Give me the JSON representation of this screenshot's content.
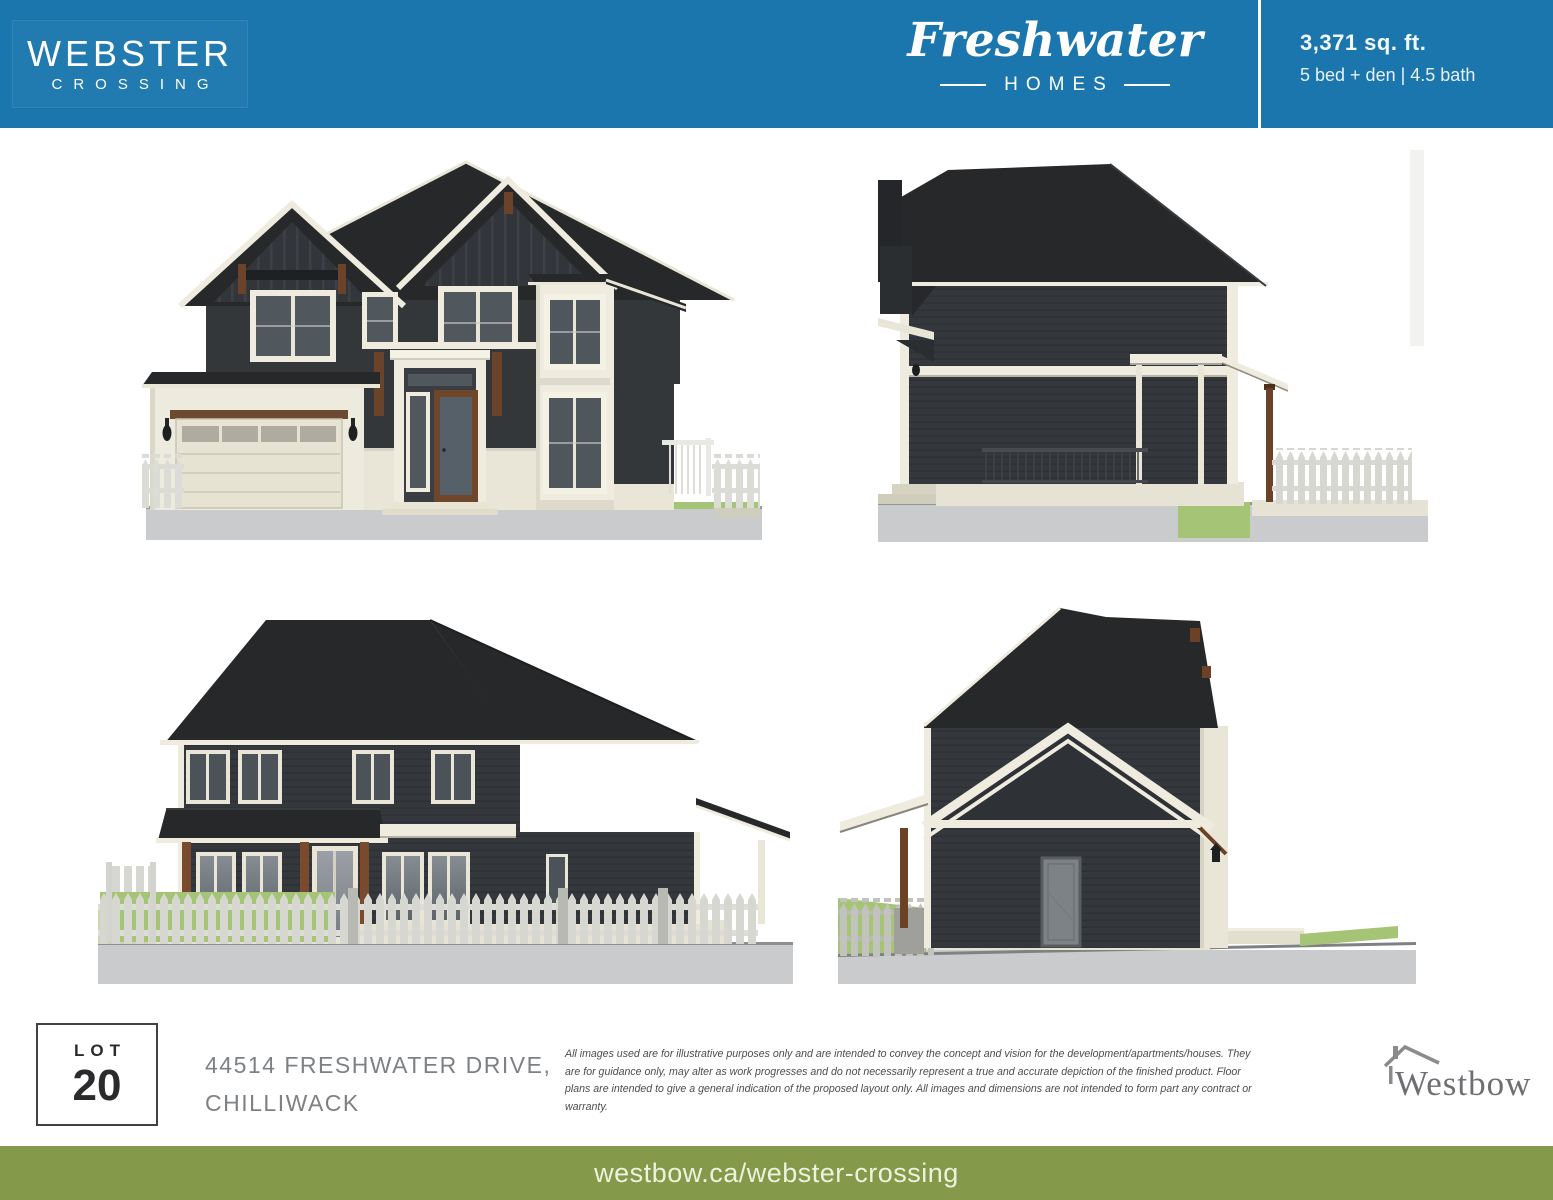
{
  "header": {
    "bg_color": "#1a76ad",
    "community_name": {
      "line1": "WEBSTER",
      "line2": "CROSSING"
    },
    "builder_logo": {
      "script_text": "Freshwater",
      "subtitle": "HOMES"
    },
    "specs": {
      "area": "3,371 sq. ft.",
      "config": "5 bed + den | 4.5 bath"
    }
  },
  "renderings": [
    {
      "name": "elevation-front"
    },
    {
      "name": "elevation-side-right"
    },
    {
      "name": "elevation-rear"
    },
    {
      "name": "elevation-side-left"
    }
  ],
  "lot": {
    "label": "LOT",
    "number": "20"
  },
  "address": {
    "line1": "44514 FRESHWATER DRIVE,",
    "line2": "CHILLIWACK"
  },
  "disclaimer": "All images used are for illustrative purposes only and are intended to convey the concept and vision for the development/apartments/houses. They are for guidance only, may alter as work progresses and do not necessarily represent a true and accurate depiction of the finished product. Floor plans are intended to give a general indication of the proposed layout only. All images and dimensions are not intended to form part any contract or warranty.",
  "builder_footer": {
    "wordmark": "Westbow",
    "house_icon": "house-roof-icon"
  },
  "footer": {
    "bg_color": "#84994a",
    "url_text": "westbow.ca/webster-crossing"
  },
  "palette": {
    "roof": "#27282a",
    "siding": "#34373a",
    "trim": "#efecdf",
    "brown_accent": "#6b4328",
    "grass": "#a6c475",
    "ground": "#cacbcc",
    "address_gray": "#7e8184"
  }
}
